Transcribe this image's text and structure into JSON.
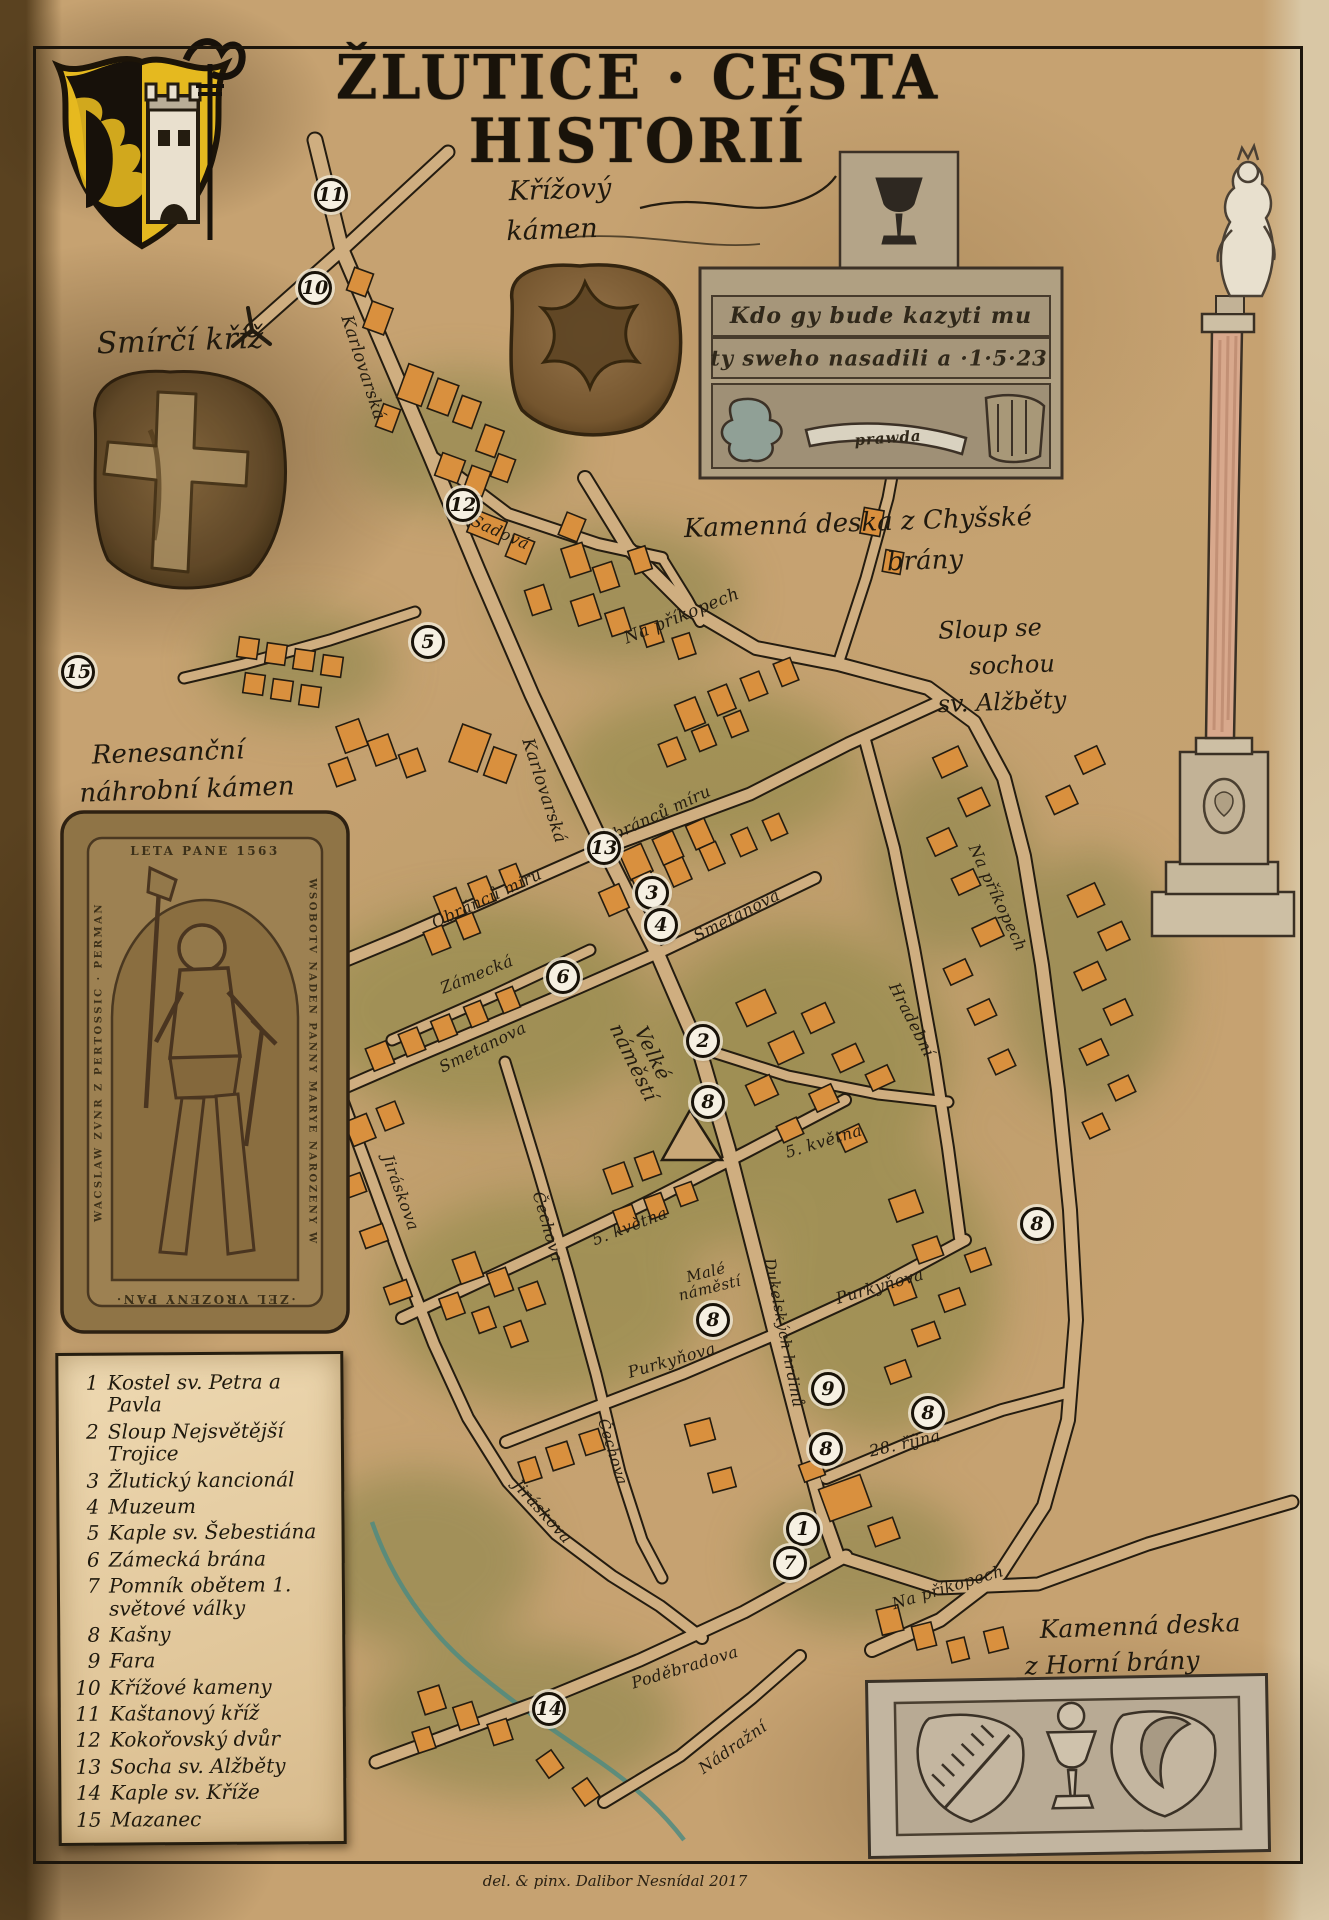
{
  "title": "ŽLUTICE · CESTA HISTORIÍ",
  "captions": {
    "smirci_kriz": "Smírčí kříž",
    "krizovy_kamen_1": "Křížový",
    "krizovy_kamen_2": "kámen",
    "deska_chysske_1": "Kamenná deska z Chyšské",
    "deska_chysske_2": "brány",
    "sloup_1": "Sloup se",
    "sloup_2": "sochou",
    "sloup_3": "sv. Alžběty",
    "nahrobni_1": "Renesanční",
    "nahrobni_2": "náhrobní kámen",
    "deska_horni_1": "Kamenná deska",
    "deska_horni_2": "z Horní brány"
  },
  "tablet_chysske": {
    "line1": "Kdo gy bude kazyti mu",
    "line2": "ty sweho nasadili a ·1·5·23",
    "banner": "prawda"
  },
  "tombstone": {
    "top": "LETA PANE 1563",
    "right": "WSOBOTV NADEN PANNY MARYE NAROZENY W",
    "left": "WACSLAW ZVNR Z PERTOSSIC · PERMAN",
    "bottom": "·ZEL VROZENY PAN·"
  },
  "signature": "del. & pinx. Dalibor Nesnídal 2017",
  "legend": {
    "items": [
      {
        "num": "1",
        "label": "Kostel sv. Petra a Pavla"
      },
      {
        "num": "2",
        "label": "Sloup Nejsvětější Trojice"
      },
      {
        "num": "3",
        "label": "Žlutický kancionál"
      },
      {
        "num": "4",
        "label": "Muzeum"
      },
      {
        "num": "5",
        "label": "Kaple sv. Šebestiána"
      },
      {
        "num": "6",
        "label": "Zámecká brána"
      },
      {
        "num": "7",
        "label": "Pomník obětem 1. světové války"
      },
      {
        "num": "8",
        "label": "Kašny"
      },
      {
        "num": "9",
        "label": "Fara"
      },
      {
        "num": "10",
        "label": "Křížové kameny"
      },
      {
        "num": "11",
        "label": "Kaštanový kříž"
      },
      {
        "num": "12",
        "label": "Kokořovský dvůr"
      },
      {
        "num": "13",
        "label": "Socha sv. Alžběty"
      },
      {
        "num": "14",
        "label": "Kaple sv. Kříže"
      },
      {
        "num": "15",
        "label": "Mazanec"
      }
    ]
  },
  "map": {
    "streets": [
      {
        "n": "Karlovarská",
        "x": 362,
        "y": 368,
        "r": 72,
        "s": 17
      },
      {
        "n": "Sadová",
        "x": 500,
        "y": 533,
        "r": 24,
        "s": 16
      },
      {
        "n": "Na příkopech",
        "x": 682,
        "y": 617,
        "r": -22,
        "s": 17
      },
      {
        "n": "Karlovarská",
        "x": 543,
        "y": 791,
        "r": 72,
        "s": 17
      },
      {
        "n": "Obránců míru",
        "x": 656,
        "y": 816,
        "r": -25,
        "s": 16
      },
      {
        "n": "Obránců míru",
        "x": 487,
        "y": 899,
        "r": -25,
        "s": 16
      },
      {
        "n": "Smetanova",
        "x": 737,
        "y": 916,
        "r": -27,
        "s": 16
      },
      {
        "n": "Zámecká",
        "x": 477,
        "y": 975,
        "r": -22,
        "s": 16
      },
      {
        "n": "Smetanova",
        "x": 483,
        "y": 1048,
        "r": -26,
        "s": 16
      },
      {
        "n": "Velké\nnáměstí",
        "x": 643,
        "y": 1058,
        "r": 64,
        "s": 20
      },
      {
        "n": "Hradební",
        "x": 911,
        "y": 1020,
        "r": 63,
        "s": 16
      },
      {
        "n": "Na příkopech",
        "x": 997,
        "y": 898,
        "r": 65,
        "s": 16
      },
      {
        "n": "5. května",
        "x": 824,
        "y": 1142,
        "r": -17,
        "s": 16
      },
      {
        "n": "5. května",
        "x": 630,
        "y": 1227,
        "r": -21,
        "s": 16
      },
      {
        "n": "Jiráskova",
        "x": 400,
        "y": 1193,
        "r": 70,
        "s": 16
      },
      {
        "n": "Čechova",
        "x": 547,
        "y": 1227,
        "r": 74,
        "s": 16
      },
      {
        "n": "Malé\nnáměstí",
        "x": 708,
        "y": 1281,
        "r": -14,
        "s": 15
      },
      {
        "n": "Purkyňova",
        "x": 880,
        "y": 1287,
        "r": -16,
        "s": 16
      },
      {
        "n": "Dukelských hrdinů",
        "x": 783,
        "y": 1333,
        "r": 79,
        "s": 15
      },
      {
        "n": "Purkyňova",
        "x": 672,
        "y": 1361,
        "r": -16,
        "s": 16
      },
      {
        "n": "28. října",
        "x": 905,
        "y": 1444,
        "r": -13,
        "s": 16
      },
      {
        "n": "Čechova",
        "x": 612,
        "y": 1452,
        "r": 73,
        "s": 15
      },
      {
        "n": "Jiráskova",
        "x": 542,
        "y": 1512,
        "r": 48,
        "s": 16
      },
      {
        "n": "Na příkopech",
        "x": 948,
        "y": 1588,
        "r": -17,
        "s": 16
      },
      {
        "n": "Poděbradova",
        "x": 685,
        "y": 1668,
        "r": -17,
        "s": 16
      },
      {
        "n": "Nádražní",
        "x": 733,
        "y": 1748,
        "r": -35,
        "s": 16
      }
    ],
    "markers": [
      {
        "n": "11",
        "x": 331,
        "y": 195
      },
      {
        "n": "10",
        "x": 315,
        "y": 288
      },
      {
        "n": "12",
        "x": 463,
        "y": 505
      },
      {
        "n": "5",
        "x": 428,
        "y": 642
      },
      {
        "n": "15",
        "x": 78,
        "y": 672
      },
      {
        "n": "13",
        "x": 604,
        "y": 848
      },
      {
        "n": "3",
        "x": 652,
        "y": 893
      },
      {
        "n": "4",
        "x": 661,
        "y": 925
      },
      {
        "n": "6",
        "x": 563,
        "y": 977
      },
      {
        "n": "2",
        "x": 703,
        "y": 1041
      },
      {
        "n": "8",
        "x": 708,
        "y": 1102
      },
      {
        "n": "8",
        "x": 1037,
        "y": 1224
      },
      {
        "n": "8",
        "x": 713,
        "y": 1320
      },
      {
        "n": "9",
        "x": 828,
        "y": 1389
      },
      {
        "n": "8",
        "x": 928,
        "y": 1413
      },
      {
        "n": "8",
        "x": 826,
        "y": 1449
      },
      {
        "n": "1",
        "x": 803,
        "y": 1529
      },
      {
        "n": "7",
        "x": 790,
        "y": 1563
      },
      {
        "n": "14",
        "x": 549,
        "y": 1709
      }
    ]
  }
}
